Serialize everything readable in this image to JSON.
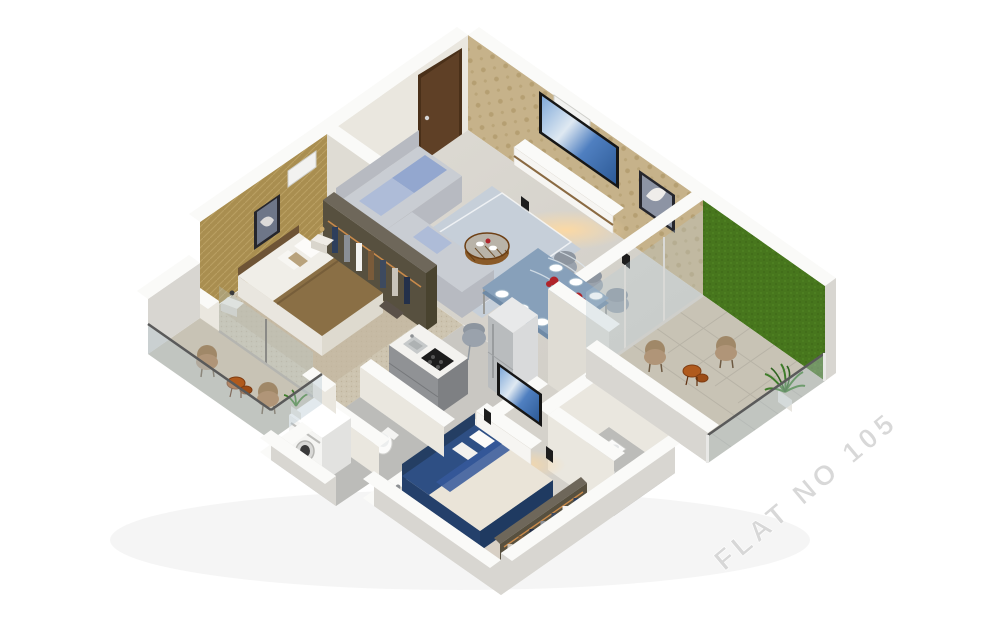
{
  "watermark": {
    "label": "FLAT NO 105"
  },
  "scene": {
    "type": "isometric-3d-floorplan-render",
    "rooms": [
      "living-dining-room",
      "grass-wall-balcony",
      "master-bedroom",
      "master-balcony",
      "kitchen",
      "common-bathroom",
      "utility-area",
      "bedroom-2",
      "bathroom-2"
    ]
  },
  "palette": {
    "wall_top": "#fafaf8",
    "wall_face": "#eae7df",
    "wall_face_shade": "#dfdcd4",
    "wall_outer": "#d8d6d1",
    "wall_inner_mauve": "#a2979a",
    "floor_living": "#d8d5ce",
    "floor_kitchen": "#c9c7c2",
    "floor_master": "#cdc4b0",
    "floor_bedroom2": "#d5d2cb",
    "floor_balcony": "#c8c3b5",
    "floor_bath": "#bcbcb9",
    "damask_wall": "#c6b28a",
    "gold_wall": "#a98e50",
    "green_wall": "#47761d",
    "wood_door": "#5f4026",
    "wood_trim": "#7a5a33",
    "sofa": "#b7bac1",
    "sofa_seat": "#c9cdd3",
    "sofa_cushion": "#93a7cf",
    "rug_living": "#c6cfd9",
    "coffee_table": "#8a5a28",
    "dining_top": "#87a0ba",
    "chair_gray": "#9aa2ac",
    "chair_beige": "#b09578",
    "side_table": "#b05a1d",
    "bed1_duvet": "#8a6f45",
    "bed1_sheet": "#f0eee8",
    "headboard1": "#6e5436",
    "bed2_duvet": "#2e4f84",
    "bed2_sheet": "#eae4d8",
    "headboard2": "#243e63",
    "wardrobe_frame": "#57503f",
    "clothes": [
      "#2e3f5c",
      "#8a8f96",
      "#f2f2f0",
      "#7a5b3a",
      "#3d4a5f",
      "#c9c4ba",
      "#23304a"
    ],
    "tv_black": "#161616",
    "glow": "#ffc97e",
    "counter": "#f3f2ef",
    "cabinet": "#909295",
    "steel": "#c6c9ca",
    "appliance_white": "#f5f5f3",
    "glass": "#b7c9d2",
    "railing_rail": "#5a5a5a",
    "plant": "#3f7d2a",
    "flower_red": "#b0242a",
    "watermark": "#d6d6d6"
  }
}
